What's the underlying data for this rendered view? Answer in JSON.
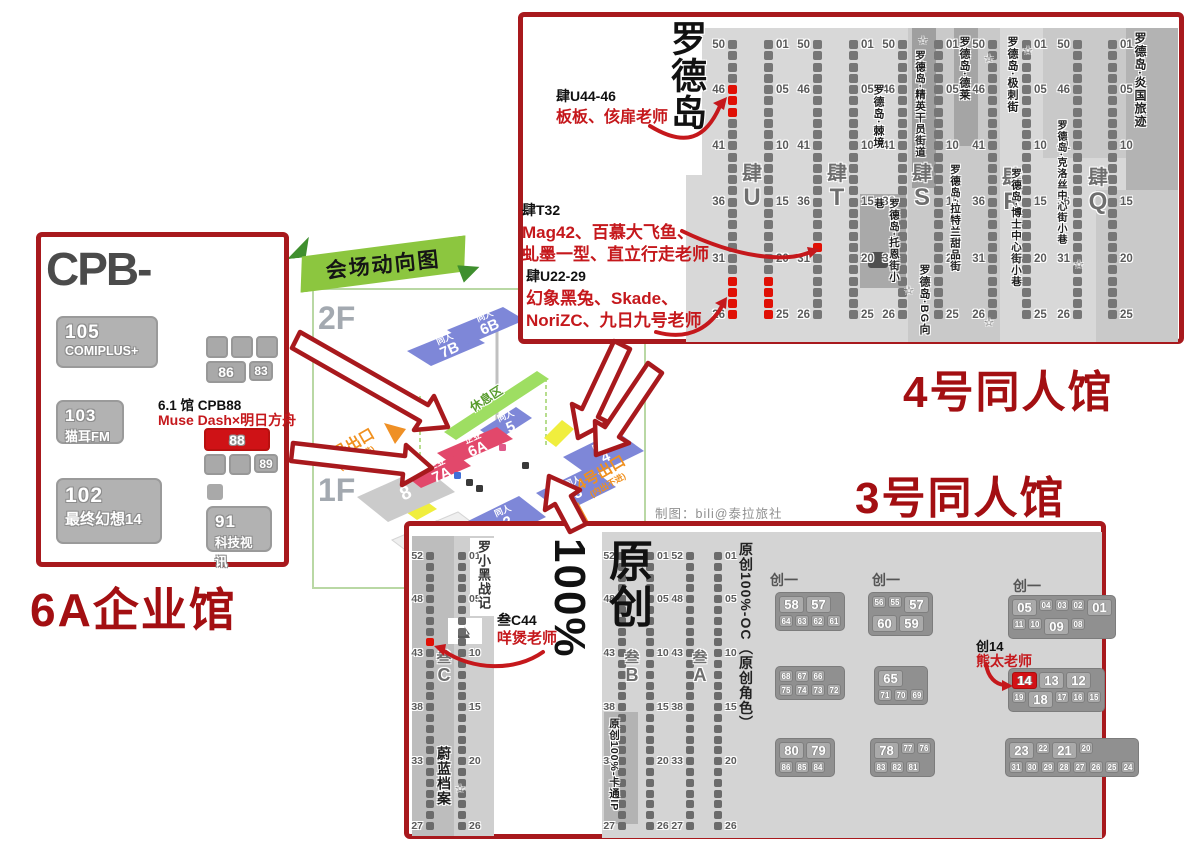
{
  "symbols": {
    "star": "☆"
  },
  "credit": "制图：bili@泰拉旅社",
  "overview": {
    "banner_title": "会场动向图",
    "floor2": "2F",
    "floor1": "1F",
    "green_zone": "休息区",
    "exit5": {
      "label": "5号出口",
      "sub": "(内出不进)"
    },
    "exit4": {
      "label": "4号出口",
      "sub": "(内出不进)"
    },
    "blocks": [
      {
        "type": "同人",
        "num": "7B"
      },
      {
        "type": "同人",
        "num": "6B"
      },
      {
        "type": "同人",
        "num": "5"
      },
      {
        "type": "企业",
        "num": "6A"
      },
      {
        "type": "企业",
        "num": "7A"
      },
      {
        "type": "",
        "num": "8"
      },
      {
        "type": "同人",
        "num": "2"
      },
      {
        "type": "同人",
        "num": "3"
      },
      {
        "type": "同人",
        "num": "4"
      },
      {
        "type": "",
        "num": "1"
      }
    ]
  },
  "hall4": {
    "title": "罗德岛",
    "hall_label": "4号同人馆",
    "aisle_prefix": "肆",
    "aisles": [
      {
        "letter": "U",
        "left_nums": [
          "50",
          "46",
          "41",
          "36",
          "31",
          "26"
        ],
        "right_nums": [
          "01",
          "05",
          "10",
          "15",
          "20",
          "25"
        ],
        "red_left": [
          4,
          5,
          6,
          21,
          22,
          23,
          24
        ],
        "red_right": [
          21,
          22,
          23,
          24
        ]
      },
      {
        "letter": "T",
        "left_nums": [
          "50",
          "46",
          "41",
          "36",
          "31",
          "26"
        ],
        "right_nums": [
          "01",
          "05",
          "10",
          "15",
          "20",
          "25"
        ],
        "red_left": [
          18
        ],
        "red_right": []
      },
      {
        "letter": "S",
        "left_nums": [
          "50",
          "46",
          "41",
          "36",
          "31",
          "26"
        ],
        "right_nums": [
          "01",
          "05",
          "10",
          "15",
          "20",
          "25"
        ],
        "red_left": [],
        "red_right": []
      },
      {
        "letter": "R",
        "left_nums": [
          "50",
          "46",
          "41",
          "36",
          "31",
          "26"
        ],
        "right_nums": [
          "01",
          "05",
          "10",
          "15",
          "20",
          "25"
        ],
        "red_left": [],
        "red_right": []
      },
      {
        "letter": "Q",
        "left_nums": [
          "50",
          "46",
          "41",
          "36",
          "31",
          "26"
        ],
        "right_nums": [
          "01",
          "05",
          "10",
          "15",
          "20",
          "25"
        ],
        "red_left": [],
        "red_right": []
      }
    ],
    "streets": {
      "jijing": "罗德岛·棘境",
      "jingying": "罗德岛·精英干员街道",
      "delai": "罗德岛·德莱",
      "jici": "罗德岛·极刺街",
      "keluosi": "罗德岛·克洛丝中心街小巷",
      "yanguo": "罗德岛·炎国旅迹",
      "tuoen": "罗德岛·托恩街小巷",
      "bg": "罗德岛·BG向",
      "latelan": "罗德岛·拉特兰甜品街",
      "boshi": "罗德岛·博士中心街小巷"
    },
    "annotations": [
      {
        "booth": "肆U44-46",
        "line1": "板板、侅扉老师",
        "line2": ""
      },
      {
        "booth": "肆T32",
        "line1": "Mag42、百慕大飞鱼、",
        "line2": "虬墨一型、直立行走老师"
      },
      {
        "booth": "肆U22-29",
        "line1": "幻象黑兔、Skade、",
        "line2": "NoriZC、九日九号老师"
      }
    ]
  },
  "hall6a": {
    "logo": "CPB-",
    "hall_label": "6A企业馆",
    "booth_105": {
      "num": "105",
      "name": "COMIPLUS+"
    },
    "booth_103": {
      "num": "103",
      "name": "猫耳FM"
    },
    "booth_102": {
      "num": "102",
      "name": "最终幻想14"
    },
    "booth_91": {
      "num": "91",
      "name": "科技视讯"
    },
    "grid1": {
      "c1": "86",
      "c2": "83"
    },
    "note_booth": "6.1 馆 CPB88",
    "note_collab": "Muse Dash×明日方舟",
    "booth_88": "88",
    "booth_89": "89"
  },
  "hall3": {
    "hall_label": "3号同人馆",
    "area_title": "原创100%",
    "aisle_prefix": "叁",
    "aisles": [
      {
        "letter": "C",
        "left_nums": [
          "52",
          "48",
          "43",
          "38",
          "33",
          "27"
        ],
        "right_nums": [
          "01",
          "05",
          "10",
          "15",
          "20",
          "26"
        ],
        "red_left": [
          8
        ],
        "red_right": []
      },
      {
        "letter": "B",
        "left_nums": [
          "52",
          "48",
          "43",
          "38",
          "33",
          "27"
        ],
        "right_nums": [
          "01",
          "05",
          "10",
          "15",
          "20",
          "26"
        ],
        "red_left": [],
        "red_right": []
      },
      {
        "letter": "A",
        "left_nums": [
          "52",
          "48",
          "43",
          "38",
          "33",
          "27"
        ],
        "right_nums": [
          "01",
          "05",
          "10",
          "15",
          "20",
          "26"
        ],
        "red_left": [],
        "red_right": []
      }
    ],
    "labels": {
      "luoxiaohei": "罗小黑战记",
      "weilan": "蔚蓝档案",
      "cartoon_ip": "原创100%-卡通IP",
      "oc": "原创100%-OC（原创角色）"
    },
    "annotations": [
      {
        "booth": "叁C44",
        "names": "咩煲老师"
      },
      {
        "booth": "创14",
        "names": "熊太老师"
      }
    ],
    "block_label": "创一",
    "blocks": [
      {
        "rows": [
          [
            {
              "t": "58",
              "big": 1
            },
            {
              "t": "57",
              "big": 1
            }
          ],
          [
            {
              "t": "64"
            },
            {
              "t": "63"
            },
            {
              "t": "62"
            },
            {
              "t": "61"
            }
          ]
        ]
      },
      {
        "rows": [
          [
            {
              "t": "56"
            },
            {
              "t": "55"
            },
            {
              "t": "57",
              "big": 1
            }
          ],
          [
            {
              "t": "60",
              "big": 1
            },
            {
              "t": "59",
              "big": 1
            }
          ]
        ]
      },
      {
        "rows": [
          [
            {
              "t": "05",
              "big": 1
            },
            {
              "t": "04"
            },
            {
              "t": "03"
            },
            {
              "t": "02"
            },
            {
              "t": "01",
              "big": 1
            }
          ],
          [
            {
              "t": "11"
            },
            {
              "t": "10"
            },
            {
              "t": "09",
              "big": 1
            },
            {
              "t": "08"
            }
          ]
        ]
      },
      {
        "rows": [
          [
            {
              "t": "68"
            },
            {
              "t": "67"
            },
            {
              "t": "66"
            }
          ],
          [
            {
              "t": "75"
            },
            {
              "t": "74"
            },
            {
              "t": "73"
            },
            {
              "t": "72"
            }
          ]
        ]
      },
      {
        "rows": [
          [
            {
              "t": "65",
              "big": 1
            }
          ],
          [
            {
              "t": "71"
            },
            {
              "t": "70"
            },
            {
              "t": "69"
            }
          ]
        ]
      },
      {
        "rows": [
          [
            {
              "t": "14",
              "big": 1,
              "red": 1
            },
            {
              "t": "13",
              "big": 1
            },
            {
              "t": "12",
              "big": 1
            }
          ],
          [
            {
              "t": "19"
            },
            {
              "t": "18",
              "big": 1
            },
            {
              "t": "17"
            },
            {
              "t": "16"
            },
            {
              "t": "15"
            }
          ]
        ]
      },
      {
        "rows": [
          [
            {
              "t": "80",
              "big": 1
            },
            {
              "t": "79",
              "big": 1
            }
          ],
          [
            {
              "t": "86"
            },
            {
              "t": "85"
            },
            {
              "t": "84"
            }
          ]
        ]
      },
      {
        "rows": [
          [
            {
              "t": "78",
              "big": 1
            },
            {
              "t": "77"
            },
            {
              "t": "76"
            }
          ],
          [
            {
              "t": "83"
            },
            {
              "t": "82"
            },
            {
              "t": "81"
            }
          ]
        ]
      },
      {
        "rows": [
          [
            {
              "t": "23",
              "big": 1
            },
            {
              "t": "22"
            },
            {
              "t": "21",
              "big": 1
            },
            {
              "t": "20"
            }
          ],
          [
            {
              "t": "31"
            },
            {
              "t": "30"
            },
            {
              "t": "29"
            },
            {
              "t": "28"
            },
            {
              "t": "27"
            },
            {
              "t": "26"
            },
            {
              "t": "25"
            },
            {
              "t": "24"
            }
          ]
        ]
      }
    ]
  }
}
